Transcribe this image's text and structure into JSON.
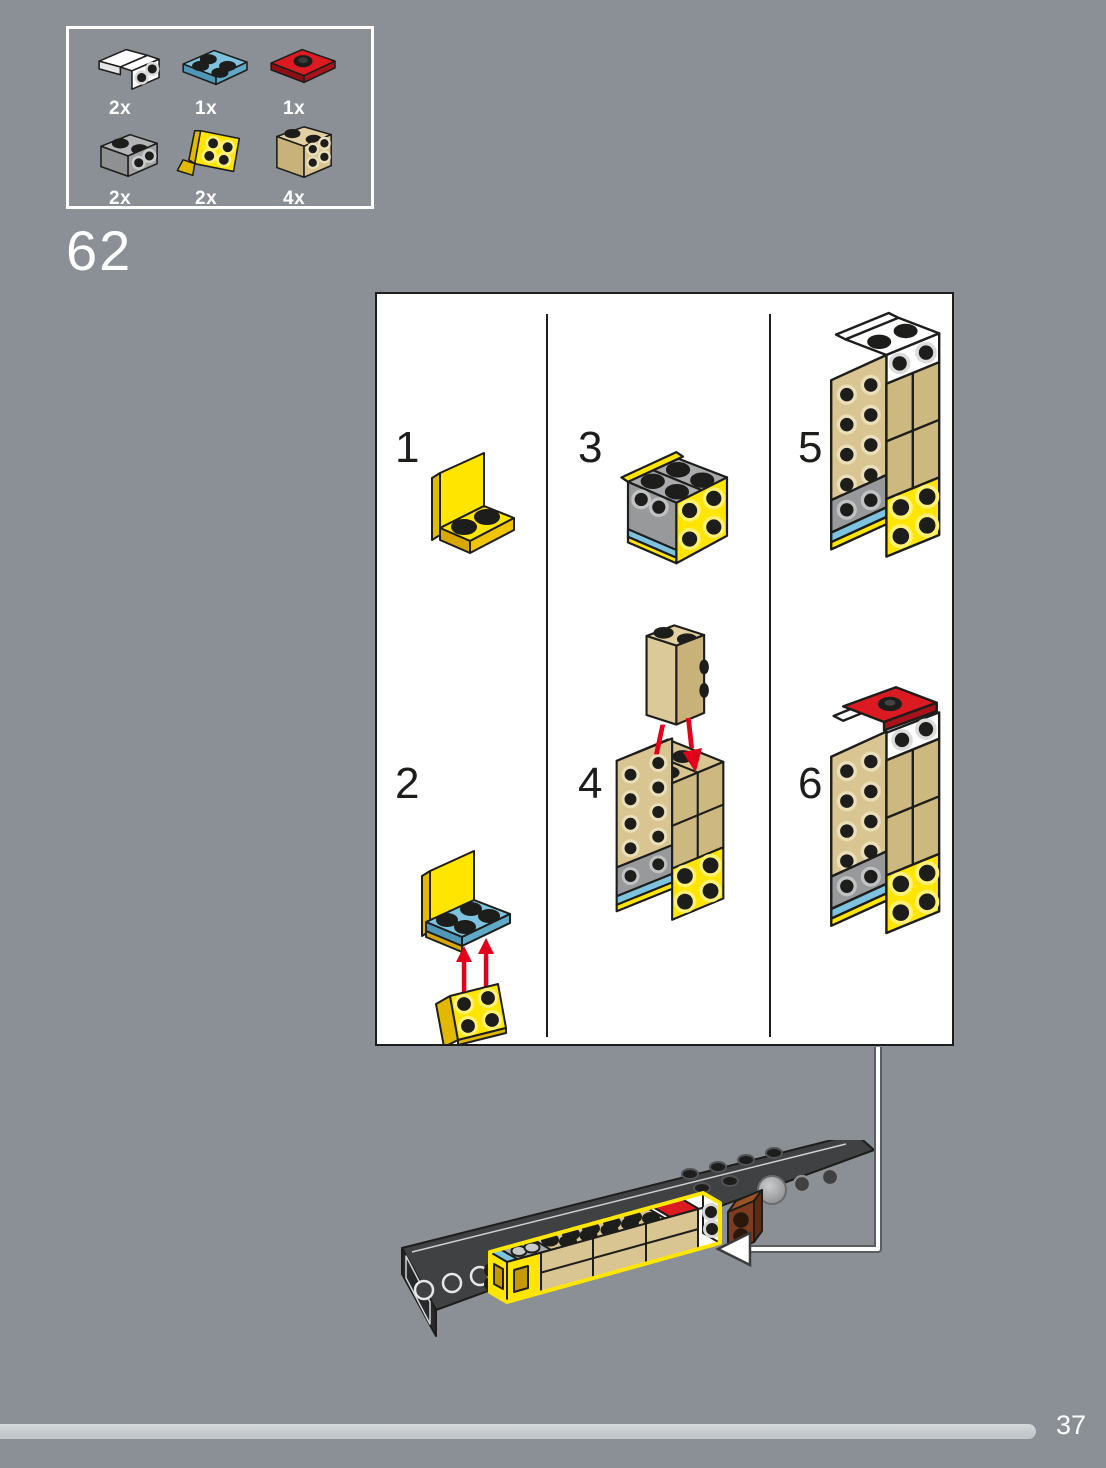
{
  "page": {
    "step_number": "62",
    "background_color": "#8A9095"
  },
  "parts_box": {
    "items": [
      {
        "qty": "2x",
        "part": "white-bracket-1x2-1x2"
      },
      {
        "qty": "1x",
        "part": "medium-azure-plate-2x2"
      },
      {
        "qty": "1x",
        "part": "red-plate-2x2-center-stud"
      },
      {
        "qty": "2x",
        "part": "gray-brick-1x2-side-studs"
      },
      {
        "qty": "2x",
        "part": "yellow-bracket-1x2-2x2"
      },
      {
        "qty": "4x",
        "part": "tan-brick-1x2-side-studs"
      }
    ]
  },
  "instruction_panel": {
    "substeps": [
      {
        "label": "1",
        "illustration": "yellow-bracket"
      },
      {
        "label": "2",
        "illustration": "azure-plate-onto-bracket-with-arrows"
      },
      {
        "label": "3",
        "illustration": "gray-side-stud-bricks-added"
      },
      {
        "label": "4",
        "illustration": "tan-brick-tower-with-arrows"
      },
      {
        "label": "5",
        "illustration": "white-brackets-added"
      },
      {
        "label": "6",
        "illustration": "red-plate-added"
      }
    ]
  },
  "placement": {
    "illustration": "subassembly-attached-to-chassis"
  },
  "footer": {
    "page_number": "37"
  },
  "colors": {
    "background": "#8A9095",
    "panel_white": "#FFFFFF",
    "outline": "#1D1D1B",
    "lego_yellow": "#FFE500",
    "lego_azure": "#7DC3E0",
    "lego_red": "#DC1A22",
    "lego_tan": "#D9C591",
    "lego_gray": "#A0A2A4",
    "lego_brown": "#7E3B1E",
    "chassis_dark": "#3F4143",
    "arrow_red": "#E2001A",
    "highlight_yellow": "#FFE600",
    "progress_bar": "#C5CACE"
  }
}
